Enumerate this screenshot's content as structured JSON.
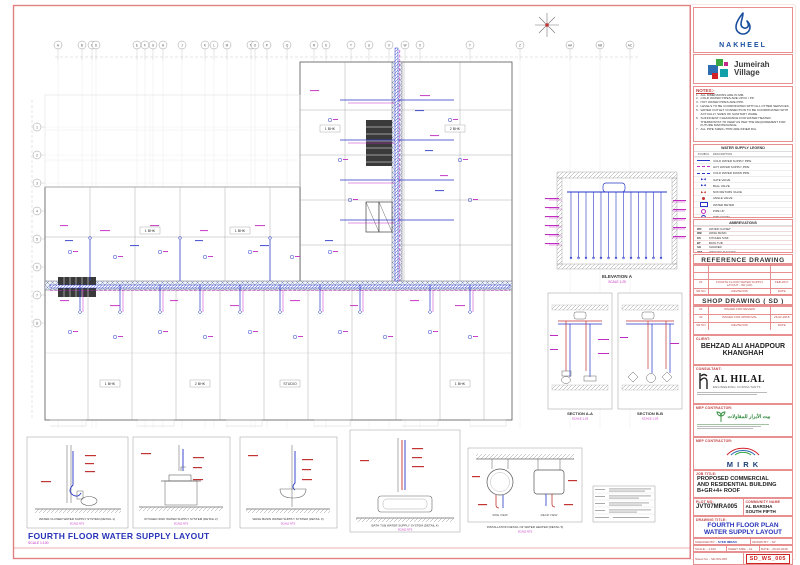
{
  "colors": {
    "frame_red": "#e08080",
    "accent_red": "#c03a3a",
    "pipe_blue": "#2736c8",
    "pipe_magenta": "#c22bc2",
    "pipe_hot_red": "#c23333",
    "title_blue": "#2733b8",
    "nakheel_blue": "#1a4f9e"
  },
  "logos": {
    "nakheel": "NAKHEEL",
    "jumeirah_line1": "Jumeirah",
    "jumeirah_line2": "Village"
  },
  "grid": {
    "top_letters": [
      "A",
      "B",
      "C",
      "D",
      "E",
      "F",
      "G",
      "H",
      "J",
      "K",
      "L",
      "M",
      "N",
      "O",
      "P",
      "Q",
      "R",
      "S",
      "T",
      "U",
      "V",
      "W",
      "X",
      "Y",
      "Z",
      "AA",
      "AB",
      "AC"
    ],
    "left_labels": [
      "1",
      "2",
      "3",
      "4",
      "5",
      "6",
      "7",
      "8"
    ]
  },
  "plan": {
    "title": "FOURTH FLOOR WATER SUPPLY LAYOUT",
    "scale": "SCALE 1:100",
    "room_labels": [
      "1 BHK",
      "1 BHK",
      "1 BHK",
      "2 BHK",
      "1 BHK",
      "2 BHK",
      "STUDIO",
      "1 BHK"
    ]
  },
  "elevation": {
    "caption": "ELEVATION A",
    "scale": "SCALE 1:25"
  },
  "sections": [
    {
      "caption": "SECTION A-A",
      "scale": "SCALE 1:25"
    },
    {
      "caption": "SECTION B-B",
      "scale": "SCALE 1:25"
    }
  ],
  "details": [
    {
      "caption": "WATER CLOSER WATER SUPPLY SYSTEM (DETAIL 1)",
      "scale": "SCALE NTS"
    },
    {
      "caption": "KITCHEN SINK WATER SUPPLY SYSTEM (DETAIL 2)",
      "scale": "SCALE NTS"
    },
    {
      "caption": "WASH BASIN WATER SUPPLY SYSTEM (DETAIL 3)",
      "scale": "SCALE NTS"
    },
    {
      "caption": "BATH TUB WATER SUPPLY SYSTEM (DETAIL 4)",
      "scale": "SCALE NTS"
    },
    {
      "caption": "INSTALLATION DETAIL OF WATER HEATER (DETAIL 5)",
      "scale": "SCALE NTS",
      "view1": "SIDE VIEW",
      "view2": "REAR VIEW"
    }
  ],
  "panel": {
    "notes": {
      "heading": "NOTES:-",
      "items": [
        "ALL DIMENSIONS ARE IN MM.",
        "COLD WATER PIPES ARE UPVC / PP.",
        "HOT WATER PIPES ARE PPR.",
        "LEVELS TO BE COORDINATED WITH ALL OTHER SERVICES.",
        "WATER OUTLET CONNECTION TO BE COORDINATED WITH ACTUALLY SIZES OF SANITARY WARE.",
        "SUFFICIENT CLEARANCE FOR WATER HEATER THERMOSTAT TO KEEP AS PER THE REQUIREMENT FOR FUTURE MAINTENANCE.",
        "ALL PIPE SIZES / PPR ARE INNER DIA."
      ]
    },
    "legend": {
      "title": "WATER SUPPLY LEGEND",
      "col_symbol": "SYMBOL",
      "col_desc": "DESCRIPTION",
      "rows": [
        {
          "sym": "line-blue",
          "desc": "COLD WATER SUPPLY PIPE"
        },
        {
          "sym": "line-magenta",
          "desc": "HOT WATER SUPPLY PIPE"
        },
        {
          "sym": "line-blue-dash",
          "desc": "COLD WATER DOWN PIPE"
        },
        {
          "sym": "valve-blue",
          "desc": "GATE VALVE"
        },
        {
          "sym": "valve-blue",
          "desc": "BALL VALVE"
        },
        {
          "sym": "valve-red",
          "desc": "NON RETURN VALVE"
        },
        {
          "sym": "dot-red",
          "desc": "ANGLE VALVE"
        },
        {
          "sym": "box-blue",
          "desc": "WATER METER"
        },
        {
          "sym": "dot-magenta",
          "desc": "PIPE UP"
        },
        {
          "sym": "dot-blue",
          "desc": "PIPE DOWN"
        }
      ]
    },
    "abbreviations": {
      "title": "ABBREVIATIONS",
      "rows": [
        {
          "abbr": "WC",
          "desc": "WATER CLOSET"
        },
        {
          "abbr": "WB",
          "desc": "WASH BASIN"
        },
        {
          "abbr": "KS",
          "desc": "KITCHEN SINK"
        },
        {
          "abbr": "BT",
          "desc": "BATH TUB"
        },
        {
          "abbr": "SH",
          "desc": "SHOWER"
        },
        {
          "abbr": "WM",
          "desc": "WASHING MACHINE"
        },
        {
          "abbr": "CW",
          "desc": "COLD WATER"
        },
        {
          "abbr": "HW",
          "desc": "HOT WATER"
        }
      ]
    },
    "reference": {
      "title": "REFERENCE DRAWING",
      "rows": [
        [
          "",
          "",
          ""
        ],
        [
          "",
          "",
          ""
        ],
        [
          "01",
          "FOURTH FLOOR WATER SUPPLY LAYOUT - SD (CR)",
          "FEB-2017"
        ],
        [
          "SR NO",
          "REVISIONS",
          "DATE"
        ]
      ]
    },
    "shop": {
      "title": "SHOP DRAWING ( SD )",
      "rows": [
        [
          "01",
          "ISSUED FOR REVIEW",
          ""
        ],
        [
          "02",
          "ISSUED FOR APPROVAL",
          "26-02-2018"
        ],
        [
          "SR NO",
          "REVISIONS",
          "DATE"
        ]
      ]
    },
    "client": {
      "label": "CLIENT:",
      "name_line1": "BEHZAD ALI AHADPOUR",
      "name_line2": "KHANGHAH"
    },
    "consultant": {
      "label": "CONSULTANT:",
      "name": "AL HILAL",
      "sub": "ENGINEERING CONSULTANTS"
    },
    "mep1": {
      "label": "MEP CONTRACTOR:",
      "name": "بيت الأبرار للمقاولات"
    },
    "mep2": {
      "label": "MEP CONTRACTOR:",
      "name": "M I R K"
    },
    "job": {
      "label": "JOB TITLE:",
      "line1": "PROPOSED COMMERCIAL",
      "line2": "AND RESIDENTIAL BUILDING",
      "line3": "B+GR+4+ ROOF"
    },
    "plot": {
      "label": "PLOT NO:",
      "value": "JVT07MRA005"
    },
    "community": {
      "label": "COMMUNITY NAME",
      "line1": "AL BARSHA",
      "line2": "SOUTH FIFTH"
    },
    "drawing": {
      "label": "DRAWING TITLE:",
      "line1": "FOURTH FLOOR PLAN",
      "line2": "WATER SUPPLY LAYOUT"
    },
    "meta": {
      "checked_label": "CHECKED BY: -",
      "checked_value": "SYED IMRAN",
      "drawn": "DRAWN BY: - SP",
      "scale": "SCALE: - 1:100",
      "sheet_size": "SHEET SIZE: - A1",
      "date": "DATE: - 26-02-2018",
      "sheet_no": "Sheet No: - SD-WS-005",
      "stamp": "SD_WS_005"
    }
  }
}
